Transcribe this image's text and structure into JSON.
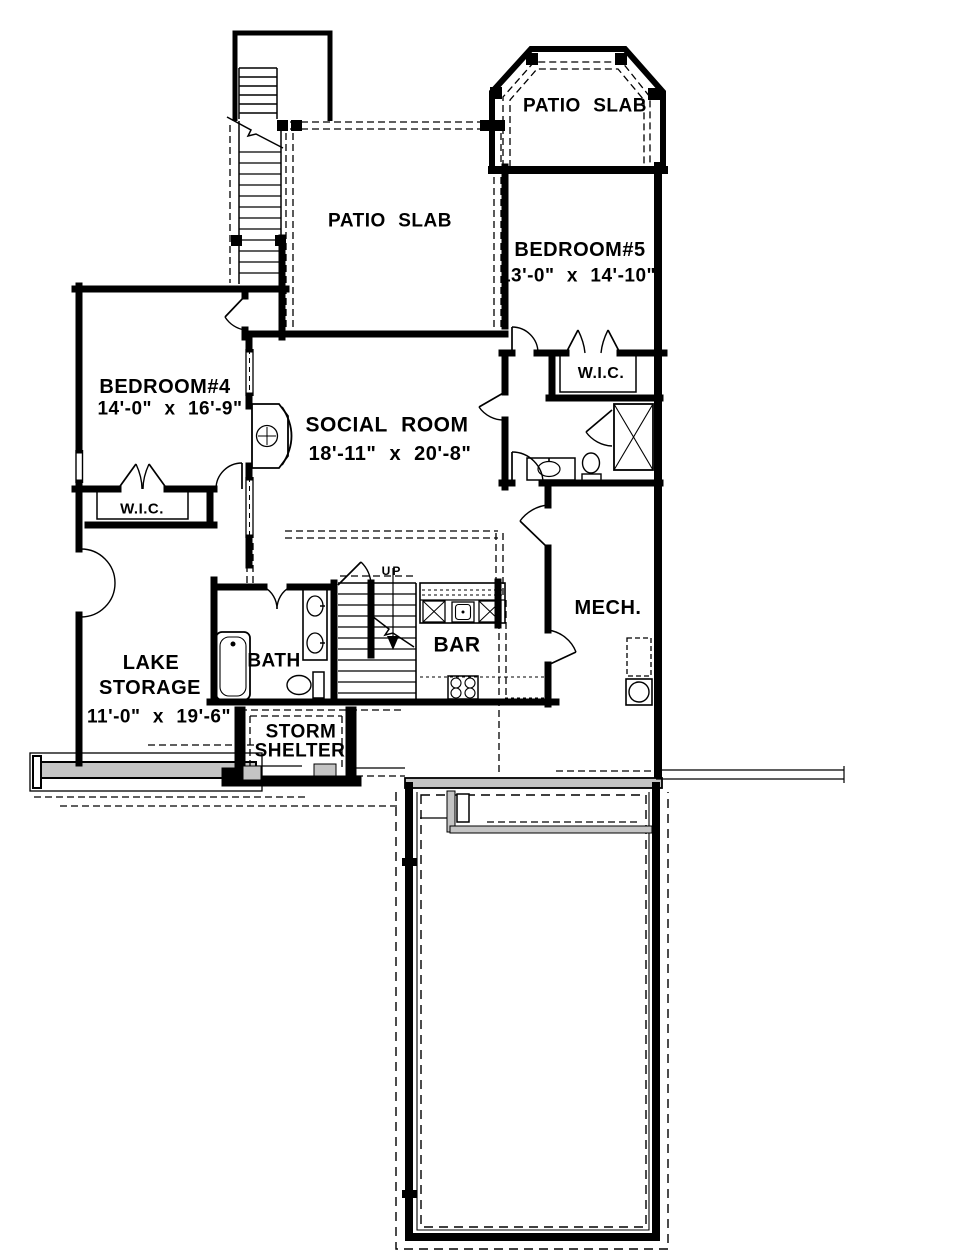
{
  "drawing": {
    "rooms": [
      {
        "id": "patio-slab-bay",
        "name": "PATIO SLAB"
      },
      {
        "id": "patio-slab-mid",
        "name": "PATIO SLAB"
      },
      {
        "id": "bedroom-5",
        "name": "BEDROOM#5",
        "dims": "13'-0\" x 14'-10\""
      },
      {
        "id": "wic-right",
        "name": "W.I.C."
      },
      {
        "id": "bedroom-4",
        "name": "BEDROOM#4",
        "dims": "14'-0\" x 16'-9\""
      },
      {
        "id": "social-room",
        "name": "SOCIAL ROOM",
        "dims": "18'-11\" x 20'-8\""
      },
      {
        "id": "wic-left",
        "name": "W.I.C."
      },
      {
        "id": "lake-storage",
        "name": "LAKE",
        "name2": "STORAGE",
        "dims": "11'-0\" x 19'-6\""
      },
      {
        "id": "bath",
        "name": "BATH"
      },
      {
        "id": "stairs",
        "name": "UP"
      },
      {
        "id": "bar",
        "name": "BAR"
      },
      {
        "id": "mech",
        "name": "MECH."
      },
      {
        "id": "storm-shelter",
        "name": "STORM",
        "name2": "SHELTER"
      }
    ],
    "colors": {
      "line": "#000000",
      "window_band": "#8f8f8f",
      "concrete_hatch": "#c4c4c4",
      "background": "#ffffff"
    }
  }
}
